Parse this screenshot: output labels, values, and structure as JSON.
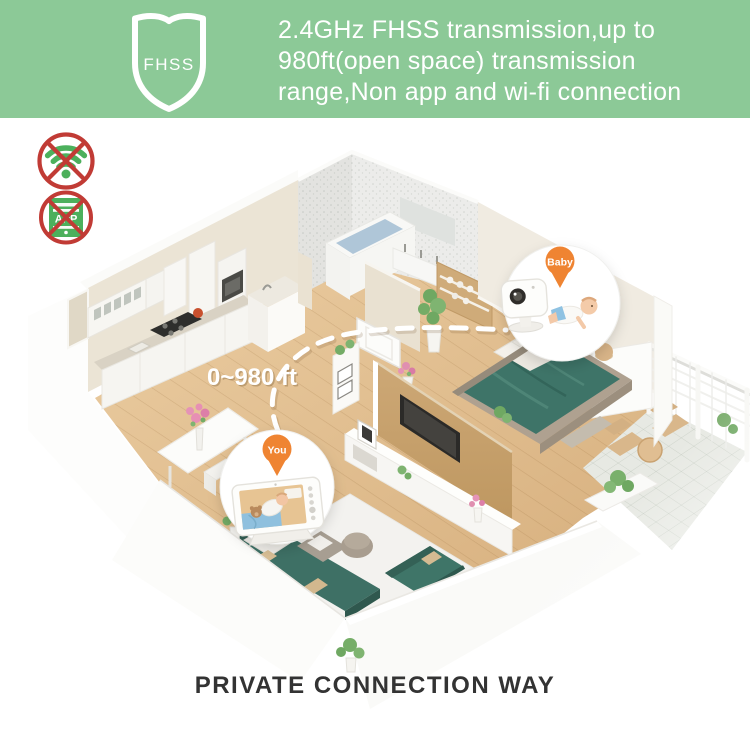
{
  "header": {
    "badge_label": "FHSS",
    "line1": "2.4GHz FHSS transmission,up to",
    "line2": "980ft(open space) transmission",
    "line3": "range,Non app and wi-fi connection",
    "bg_color": "#8CC997",
    "text_color": "#FFFFFF"
  },
  "restriction_badges": {
    "app_label": "APP",
    "prohibited_color": "#C13B35",
    "icon_color": "#4CB05C"
  },
  "floorplan": {
    "distance_label": "0~980 ft",
    "camera_location_pin": "Baby",
    "monitor_location_pin": "You",
    "pin_color": "#EF8432",
    "connection_line_color": "#FFFFFF"
  },
  "footer": {
    "title": "PRIVATE CONNECTION WAY"
  }
}
